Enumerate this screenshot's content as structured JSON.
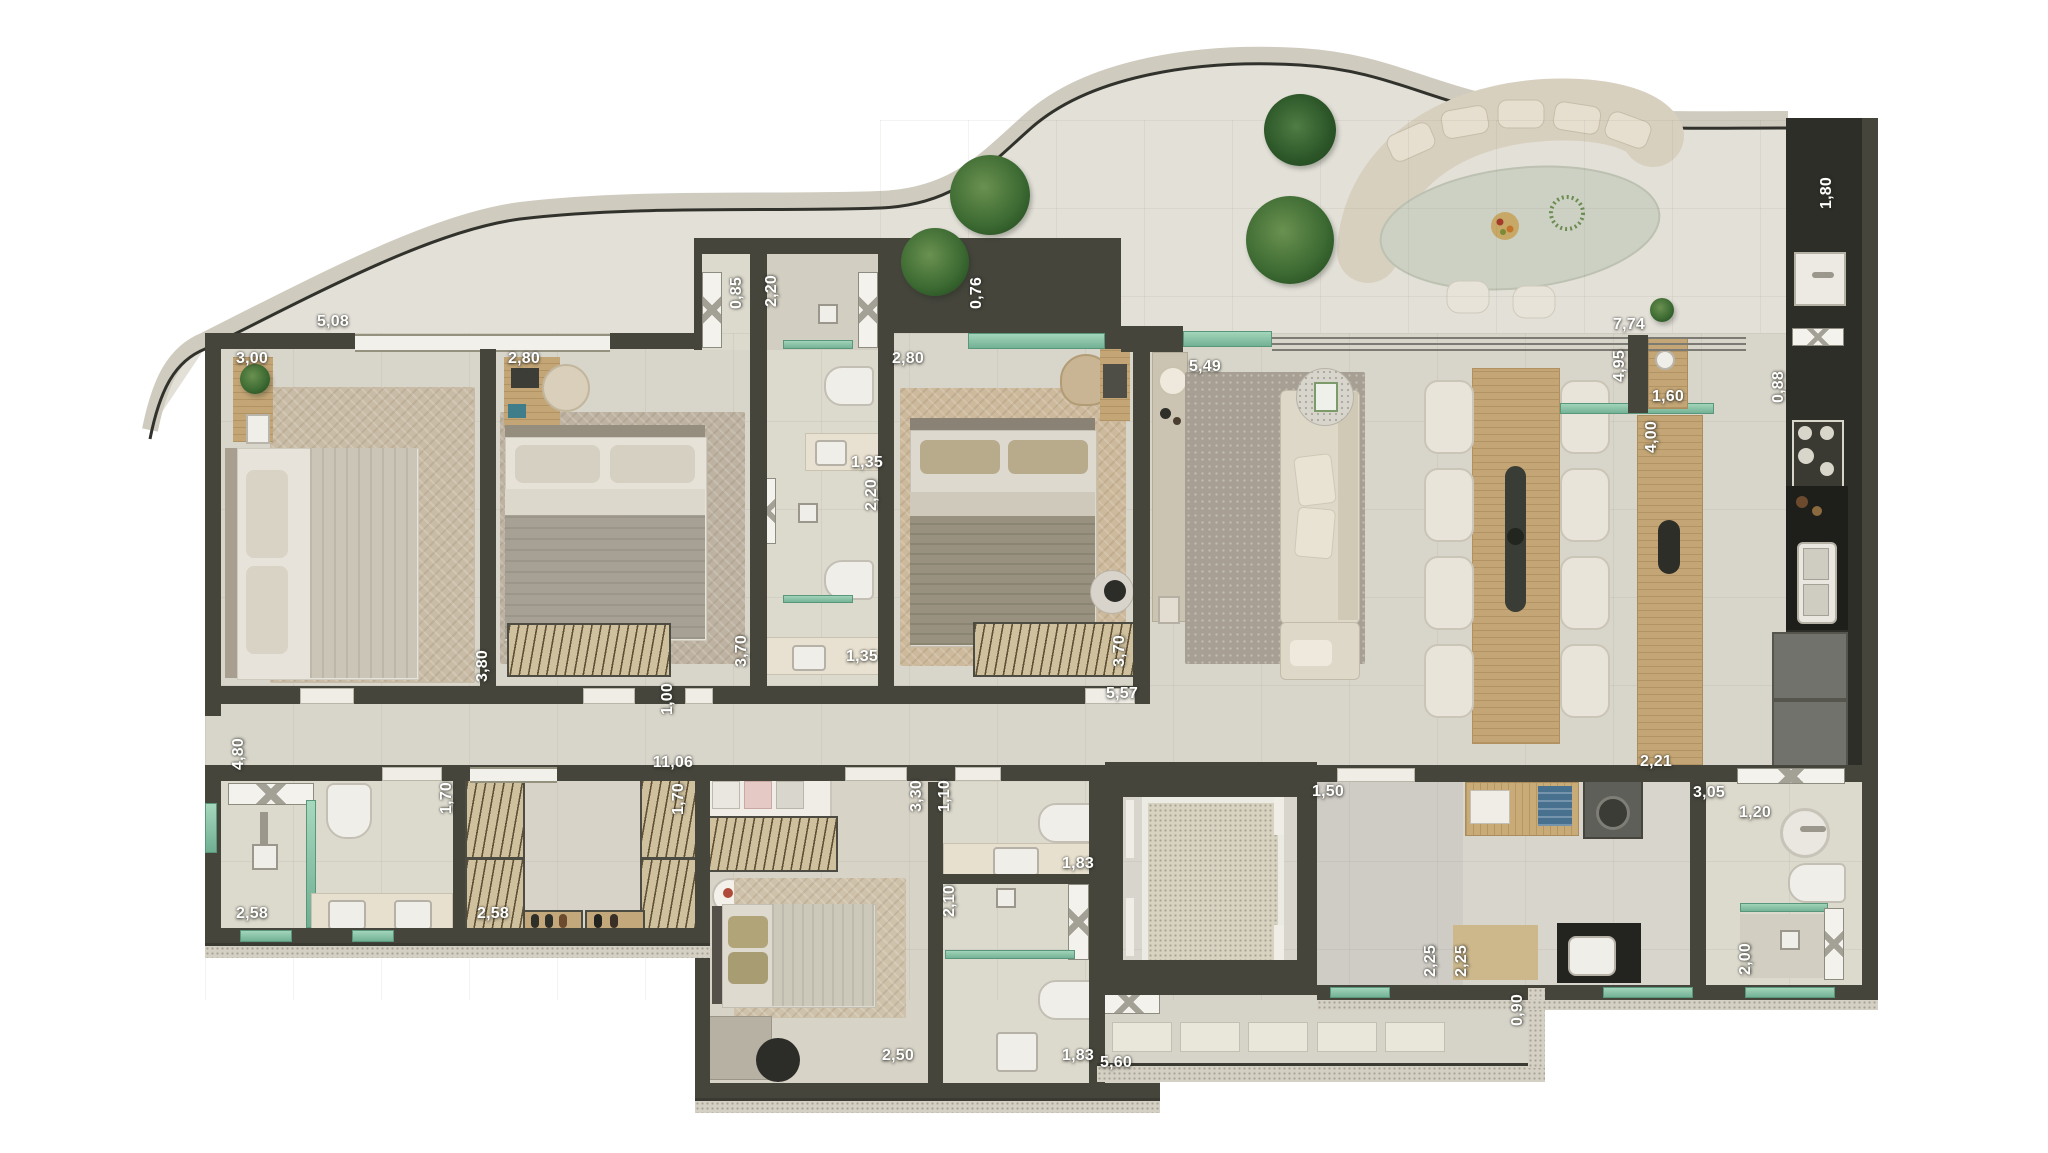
{
  "meta": {
    "type": "apartment-floor-plan",
    "units": "m",
    "visible_text": "dimension labels only"
  },
  "palette": {
    "wall": "#45453c",
    "cabinet_dark": "#2e2e28",
    "floor": "#d8d5ca",
    "bath_floor": "#dcd9cd",
    "deck": "#e3e0d8",
    "glass_teal": "#7fbfa4",
    "wood": "#c9ab77",
    "label": "#ffffff"
  },
  "dimensions": [
    {
      "label": "5,08",
      "x": 333,
      "y": 322
    },
    {
      "label": "3,00",
      "x": 252,
      "y": 359
    },
    {
      "label": "2,80",
      "x": 524,
      "y": 359
    },
    {
      "label": "0,85",
      "x": 737,
      "y": 293,
      "v": true
    },
    {
      "label": "2,20",
      "x": 772,
      "y": 291,
      "v": true
    },
    {
      "label": "0,76",
      "x": 977,
      "y": 293,
      "v": true
    },
    {
      "label": "2,80",
      "x": 908,
      "y": 359
    },
    {
      "label": "1,80",
      "x": 1827,
      "y": 193,
      "v": true
    },
    {
      "label": "7,74",
      "x": 1629,
      "y": 325
    },
    {
      "label": "4,95",
      "x": 1620,
      "y": 366,
      "v": true
    },
    {
      "label": "1,60",
      "x": 1668,
      "y": 397
    },
    {
      "label": "0,88",
      "x": 1779,
      "y": 387,
      "v": true
    },
    {
      "label": "4,00",
      "x": 1652,
      "y": 437,
      "v": true
    },
    {
      "label": "5,49",
      "x": 1205,
      "y": 367
    },
    {
      "label": "1,35",
      "x": 867,
      "y": 463
    },
    {
      "label": "2,20",
      "x": 872,
      "y": 495,
      "v": true
    },
    {
      "label": "3,80",
      "x": 483,
      "y": 666,
      "v": true
    },
    {
      "label": "3,70",
      "x": 742,
      "y": 651,
      "v": true
    },
    {
      "label": "1,35",
      "x": 862,
      "y": 657
    },
    {
      "label": "3,70",
      "x": 1120,
      "y": 651,
      "v": true
    },
    {
      "label": "5,57",
      "x": 1122,
      "y": 694
    },
    {
      "label": "1,00",
      "x": 668,
      "y": 699,
      "v": true
    },
    {
      "label": "11,06",
      "x": 673,
      "y": 763
    },
    {
      "label": "4,80",
      "x": 239,
      "y": 754,
      "v": true
    },
    {
      "label": "1,70",
      "x": 447,
      "y": 798,
      "v": true
    },
    {
      "label": "1,70",
      "x": 679,
      "y": 799,
      "v": true
    },
    {
      "label": "2,58",
      "x": 252,
      "y": 914
    },
    {
      "label": "2,58",
      "x": 493,
      "y": 914
    },
    {
      "label": "3,30",
      "x": 917,
      "y": 796,
      "v": true
    },
    {
      "label": "1,10",
      "x": 945,
      "y": 796,
      "v": true
    },
    {
      "label": "1,83",
      "x": 1078,
      "y": 864
    },
    {
      "label": "2,10",
      "x": 950,
      "y": 901,
      "v": true
    },
    {
      "label": "2,50",
      "x": 898,
      "y": 1056
    },
    {
      "label": "1,83",
      "x": 1078,
      "y": 1056
    },
    {
      "label": "5,60",
      "x": 1116,
      "y": 1063
    },
    {
      "label": "0,90",
      "x": 1518,
      "y": 1010,
      "v": true
    },
    {
      "label": "1,50",
      "x": 1328,
      "y": 792
    },
    {
      "label": "2,25",
      "x": 1431,
      "y": 961,
      "v": true
    },
    {
      "label": "2,25",
      "x": 1462,
      "y": 961,
      "v": true
    },
    {
      "label": "2,21",
      "x": 1656,
      "y": 762
    },
    {
      "label": "3,05",
      "x": 1709,
      "y": 793
    },
    {
      "label": "1,20",
      "x": 1755,
      "y": 813
    },
    {
      "label": "2,00",
      "x": 1746,
      "y": 959,
      "v": true
    }
  ]
}
